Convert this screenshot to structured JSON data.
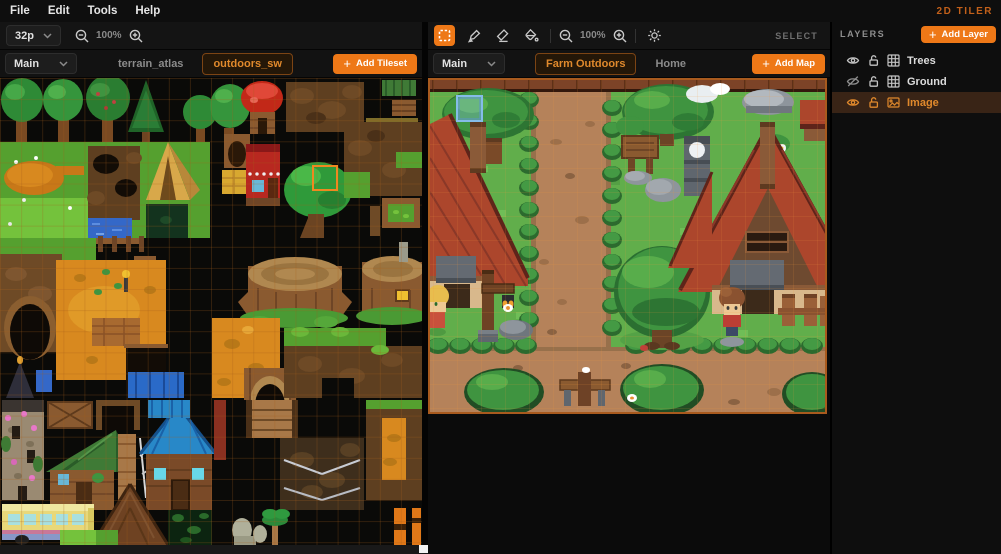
{
  "app": {
    "brand": "2D TILER"
  },
  "menu": {
    "items": {
      "file": "File",
      "edit": "Edit",
      "tools": "Tools",
      "help": "Help"
    }
  },
  "tileset_panel": {
    "tile_size_value": "32p",
    "zoom_level": "100%",
    "collection_dropdown": "Main",
    "tabs": [
      {
        "label": "terrain_atlas"
      },
      {
        "label": "outdoors_sw"
      }
    ],
    "active_tab": "outdoors_sw",
    "add_button_label": "Add Tileset",
    "plus": "+"
  },
  "map_panel": {
    "zoom_level": "100%",
    "mode_label": "SELECT",
    "collection_dropdown": "Main",
    "tabs": [
      {
        "label": "Farm Outdoors"
      },
      {
        "label": "Home"
      }
    ],
    "active_tab": "Farm Outdoors",
    "add_button_label": "Add Map",
    "plus": "+"
  },
  "layers_panel": {
    "title": "LAYERS",
    "add_button_label": "Add Layer",
    "plus": "+",
    "layers": [
      {
        "name": "Trees",
        "visible": true,
        "locked": false,
        "type": "tile",
        "selected": false
      },
      {
        "name": "Ground",
        "visible": false,
        "locked": false,
        "type": "tile",
        "selected": false
      },
      {
        "name": "Image",
        "visible": true,
        "locked": false,
        "type": "image",
        "selected": true
      }
    ]
  },
  "colors": {
    "accent": "#ee7817",
    "active_text": "#e0892c",
    "selected_layer_bg": "#392416",
    "brand_text": "#c2601a"
  }
}
